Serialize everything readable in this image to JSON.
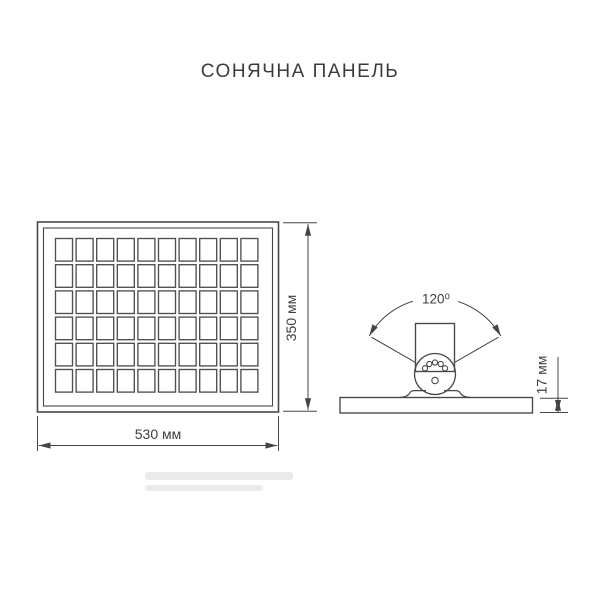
{
  "title": "СОНЯЧНА ПАНЕЛЬ",
  "front_view": {
    "description": "solar panel front view",
    "width_label": "530 мм",
    "height_label": "350 мм",
    "grid": {
      "columns": 10,
      "rows": 6
    }
  },
  "side_view": {
    "description": "mounting bracket side view",
    "angle_label": "120⁰",
    "thickness_label": "17 мм",
    "hinge_small_holes": 5,
    "hinge_center_holes": 1
  },
  "colors": {
    "line": "#474747",
    "text": "#3e3e3e",
    "background": "#ffffff"
  }
}
